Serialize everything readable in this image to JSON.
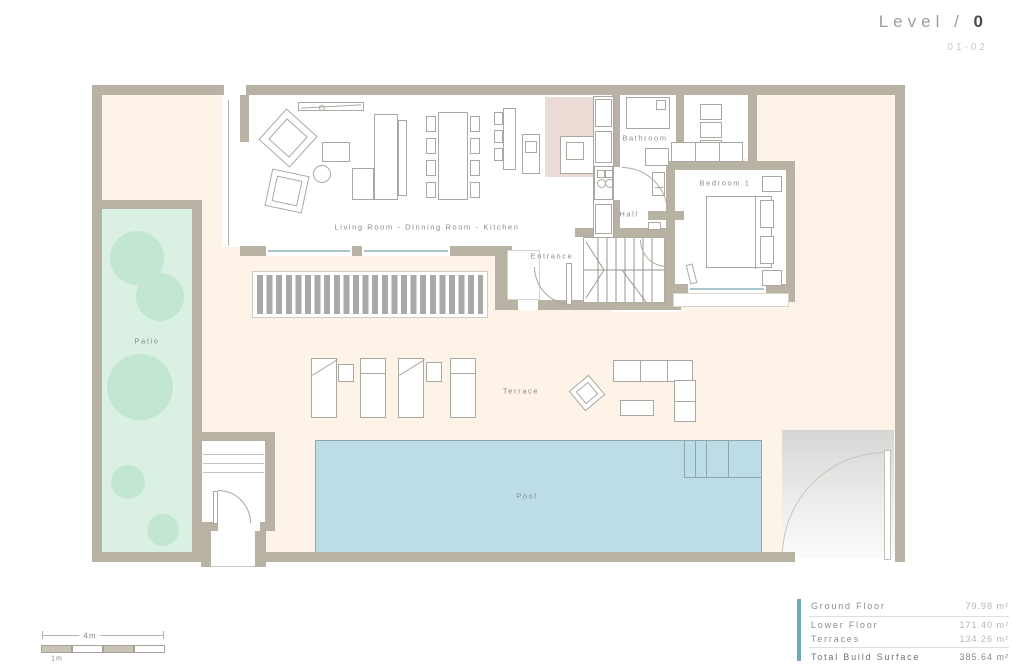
{
  "title": {
    "prefix": "Level /",
    "number": "0",
    "sheet": "01-02"
  },
  "rooms": {
    "living": "Living Room - Dinning Room - Kitchen",
    "bathroom": "Bathroom",
    "bedroom": "Bedroom 1",
    "hall": "Hall",
    "entrance": "Entrance",
    "terrace": "Terrace",
    "pool": "Pool",
    "patio": "Patio"
  },
  "summary": {
    "rows": [
      {
        "label": "Ground Floor",
        "value": "79.98 m²"
      },
      {
        "label": "Lower Floor",
        "value": "171.40 m²"
      },
      {
        "label": "Terraces",
        "value": "134.26 m²"
      }
    ],
    "total": {
      "label": "Total Build Surface",
      "value": "385.64 m²"
    },
    "accent_color": "#6fa8b6"
  },
  "scale_bar": {
    "overall": "4m",
    "unit": "1m"
  },
  "colors": {
    "wall": "#b7b2a3",
    "terrace": "#fdf3e9",
    "patio": "#daf0e3",
    "tree": "#c3e6d0",
    "pool": "#bcdde8",
    "kitchen_floor": "#eadcd5",
    "pergola": "#a9a9a9",
    "accent": "#6fa8b6",
    "label_text": "#8b8b83"
  }
}
